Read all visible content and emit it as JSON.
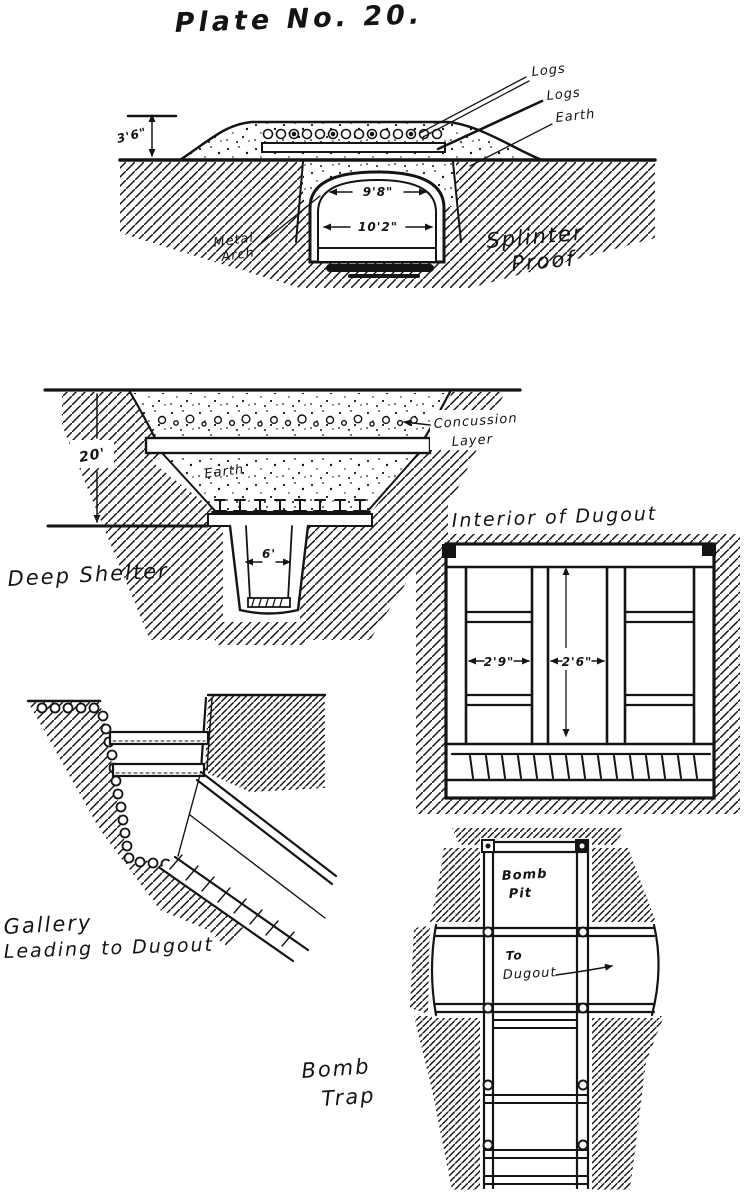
{
  "page": {
    "title": "Plate No. 20.",
    "ink_color": "#141414",
    "paper_color": "#ffffff"
  },
  "diagrams": {
    "splinter_proof": {
      "caption_line1": "Splinter",
      "caption_line2": "Proof",
      "labels": {
        "logs1": "Logs",
        "logs2": "Logs",
        "earth": "Earth",
        "metal_arch_line1": "Metal",
        "metal_arch_line2": "Arch"
      },
      "dimensions": {
        "mound_height": "3'6\"",
        "arch_top_width": "9'8\"",
        "arch_bottom_width": "10'2\""
      }
    },
    "deep_shelter": {
      "caption": "Deep Shelter",
      "labels": {
        "concussion_line1": "Concussion",
        "concussion_line2": "Layer",
        "earth": "Earth"
      },
      "dimensions": {
        "depth": "20'",
        "chamber_width": "6'"
      }
    },
    "interior_of_dugout": {
      "title": "Interior of Dugout",
      "dimensions": {
        "bay_width": "2'9\"",
        "aisle_width": "2'6\""
      }
    },
    "gallery": {
      "caption_line1": "Gallery",
      "caption_line2": "Leading to Dugout"
    },
    "bomb_trap": {
      "caption_line1": "Bomb",
      "caption_line2": "Trap",
      "labels": {
        "pit_line1": "Bomb",
        "pit_line2": "Pit",
        "to_dugout_line1": "To",
        "to_dugout_line2": "Dugout"
      }
    }
  }
}
